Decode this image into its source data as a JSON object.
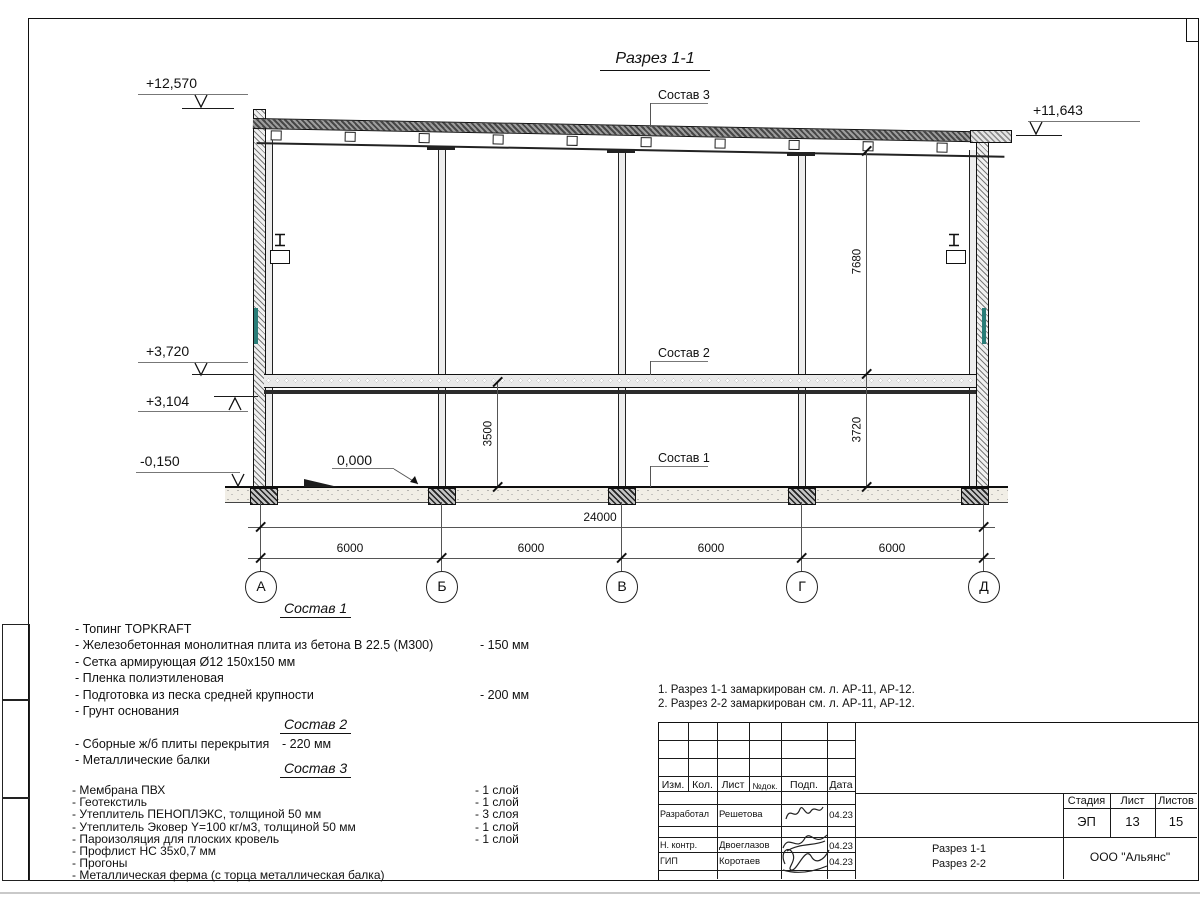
{
  "sheet": {
    "title": "Разрез 1-1",
    "labels": {
      "sostav1": "Состав 1",
      "sostav2": "Состав 2",
      "sostav3": "Состав 3"
    },
    "elevations": {
      "roof_left": "+12,570",
      "roof_right": "+11,643",
      "slab_top": "+3,720",
      "beam_bottom": "+3,104",
      "ground_out": "-0,150",
      "floor_zero": "0,000"
    },
    "dims": {
      "upper_height": "7680",
      "clear_height": "3500",
      "lower_height": "3720",
      "total": "24000",
      "bays": [
        "6000",
        "6000",
        "6000",
        "6000"
      ]
    },
    "axes": [
      "А",
      "Б",
      "В",
      "Г",
      "Д"
    ],
    "colors": {
      "line": "#1a1a1a",
      "glass": "#2a7d78",
      "roof_fill": "#6b6b6b"
    }
  },
  "spec1": {
    "heading": "Состав 1",
    "items": [
      {
        "text": "- Топинг TOPKRAFT",
        "value": ""
      },
      {
        "text": "- Железобетонная  монолитная плита из бетона  В 22.5 (М300)",
        "value": "- 150 мм"
      },
      {
        "text": "- Сетка армирующая Ø12 150х150 мм",
        "value": ""
      },
      {
        "text": "- Пленка полиэтиленовая",
        "value": ""
      },
      {
        "text": "- Подготовка из песка средней  крупности",
        "value": "- 200 мм"
      },
      {
        "text": "- Грунт основания",
        "value": ""
      }
    ]
  },
  "spec2": {
    "heading": "Состав 2",
    "items": [
      {
        "text": "- Сборные ж/б плиты перекрытия",
        "value": "- 220 мм"
      },
      {
        "text": "- Металлические балки",
        "value": ""
      }
    ]
  },
  "spec3": {
    "heading": "Состав 3",
    "items": [
      {
        "text": "- Мембрана ПВХ",
        "value": "- 1 слой"
      },
      {
        "text": "- Геотекстиль",
        "value": "- 1 слой"
      },
      {
        "text": "- Утеплитель ПЕНОПЛЭКС, толщиной 50 мм",
        "value": "- 3 слоя"
      },
      {
        "text": "- Утеплитель Эковер Y=100 кг/м3, толщиной 50 мм",
        "value": "- 1 слой"
      },
      {
        "text": "- Пароизоляция для плоских кровель",
        "value": "- 1 слой"
      },
      {
        "text": "- Профлист НС 35х0,7 мм",
        "value": ""
      },
      {
        "text": "- Прогоны",
        "value": ""
      },
      {
        "text": "- Металлическая ферма (с торца металлическая балка)",
        "value": ""
      }
    ]
  },
  "notes": {
    "line1": "1. Разрез 1-1 замаркирован см. л. АР-11, АР-12.",
    "line2": "2. Разрез 2-2 замаркирован см. л. АР-11, АР-12."
  },
  "stamp": {
    "cols": {
      "izm": "Изм.",
      "kol": "Кол.",
      "list": "Лист",
      "ndok": "№док.",
      "podp": "Подп.",
      "data": "Дата"
    },
    "rows": [
      {
        "role": "Разработал",
        "name": "Решетова",
        "date": "04.23"
      },
      {
        "role": "Н. контр.",
        "name": "Двоеглазов",
        "date": "04.23"
      },
      {
        "role": "ГИП",
        "name": "Коротаев",
        "date": "04.23"
      }
    ],
    "stage_label": "Стадия",
    "sheet_label": "Лист",
    "sheets_label": "Листов",
    "stage": "ЭП",
    "sheet_no": "13",
    "sheets_total": "15",
    "doc_line1": "Разрез 1-1",
    "doc_line2": "Разрез 2-2",
    "company": "ООО \"Альянс\""
  }
}
